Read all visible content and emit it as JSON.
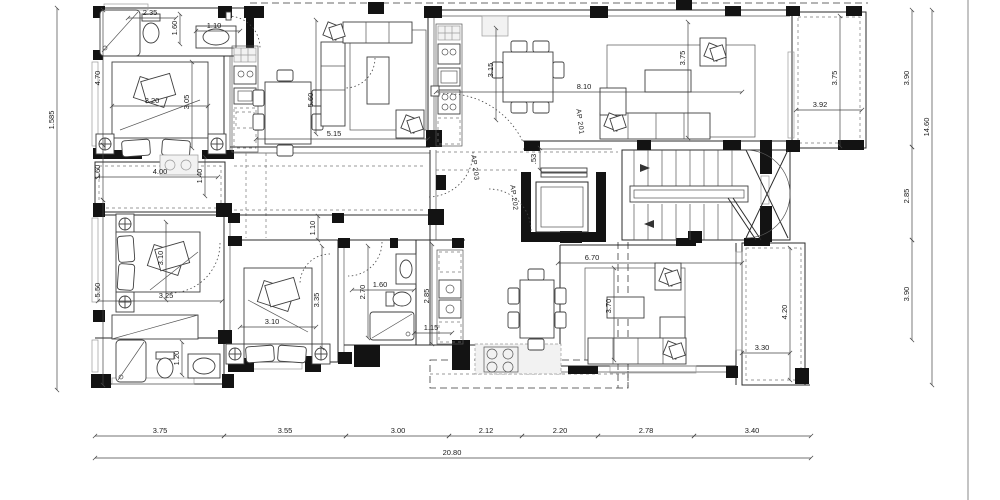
{
  "plan": {
    "type": "architectural-floor-plan",
    "colors": {
      "ink": "#1a1a1a",
      "wall_fill": "#131313",
      "light_fill": "#f2f2f2"
    },
    "labels": {
      "ap201": "AP 201",
      "ap202": "AP 202",
      "ap203": "AP 203"
    },
    "dims": {
      "bottom_segments": [
        "3.75",
        "3.55",
        "3.00",
        "2.12",
        "2.20",
        "2.78",
        "3.40"
      ],
      "bottom_total": "20.80",
      "left_segments": [
        "4.70",
        "1.60",
        "5.50"
      ],
      "left_total": "1.585",
      "right_segments": [
        "3.90",
        "2.85",
        "3.90"
      ],
      "right_total": "14.60",
      "rooms": {
        "bath_tl_width": "2.35",
        "bath_tl_depth": "1.60",
        "entry_tl_width": "1.10",
        "bed1_width": "3.20",
        "bed1_depth": "3.05",
        "balcony1_width": "4.00",
        "balcony1_depth": "1.40",
        "living1_width": "5.15",
        "living1_depth": "5.60",
        "dining2_depth": "3.15",
        "ap201_width": "8.10",
        "living2_depth": "3.75",
        "balcony2_width": "3.92",
        "balcony2_depth": "3.75",
        "door201_width": ".53",
        "bed2_depth": "3.10",
        "bed2_width": "3.25",
        "bath_bl_depth": "1.20",
        "hall_mid_depth": "1.10",
        "bed3_width": "3.10",
        "bed3_depth": "3.35",
        "hall3_depth": "2.70",
        "bath3_width": "1.60",
        "bath3_depth": "2.85",
        "kitchen3_width": "1.15",
        "living3_width": "6.70",
        "living3_depth": "3.70",
        "balcony3_width": "3.30",
        "balcony3_depth": "4.20"
      }
    }
  }
}
